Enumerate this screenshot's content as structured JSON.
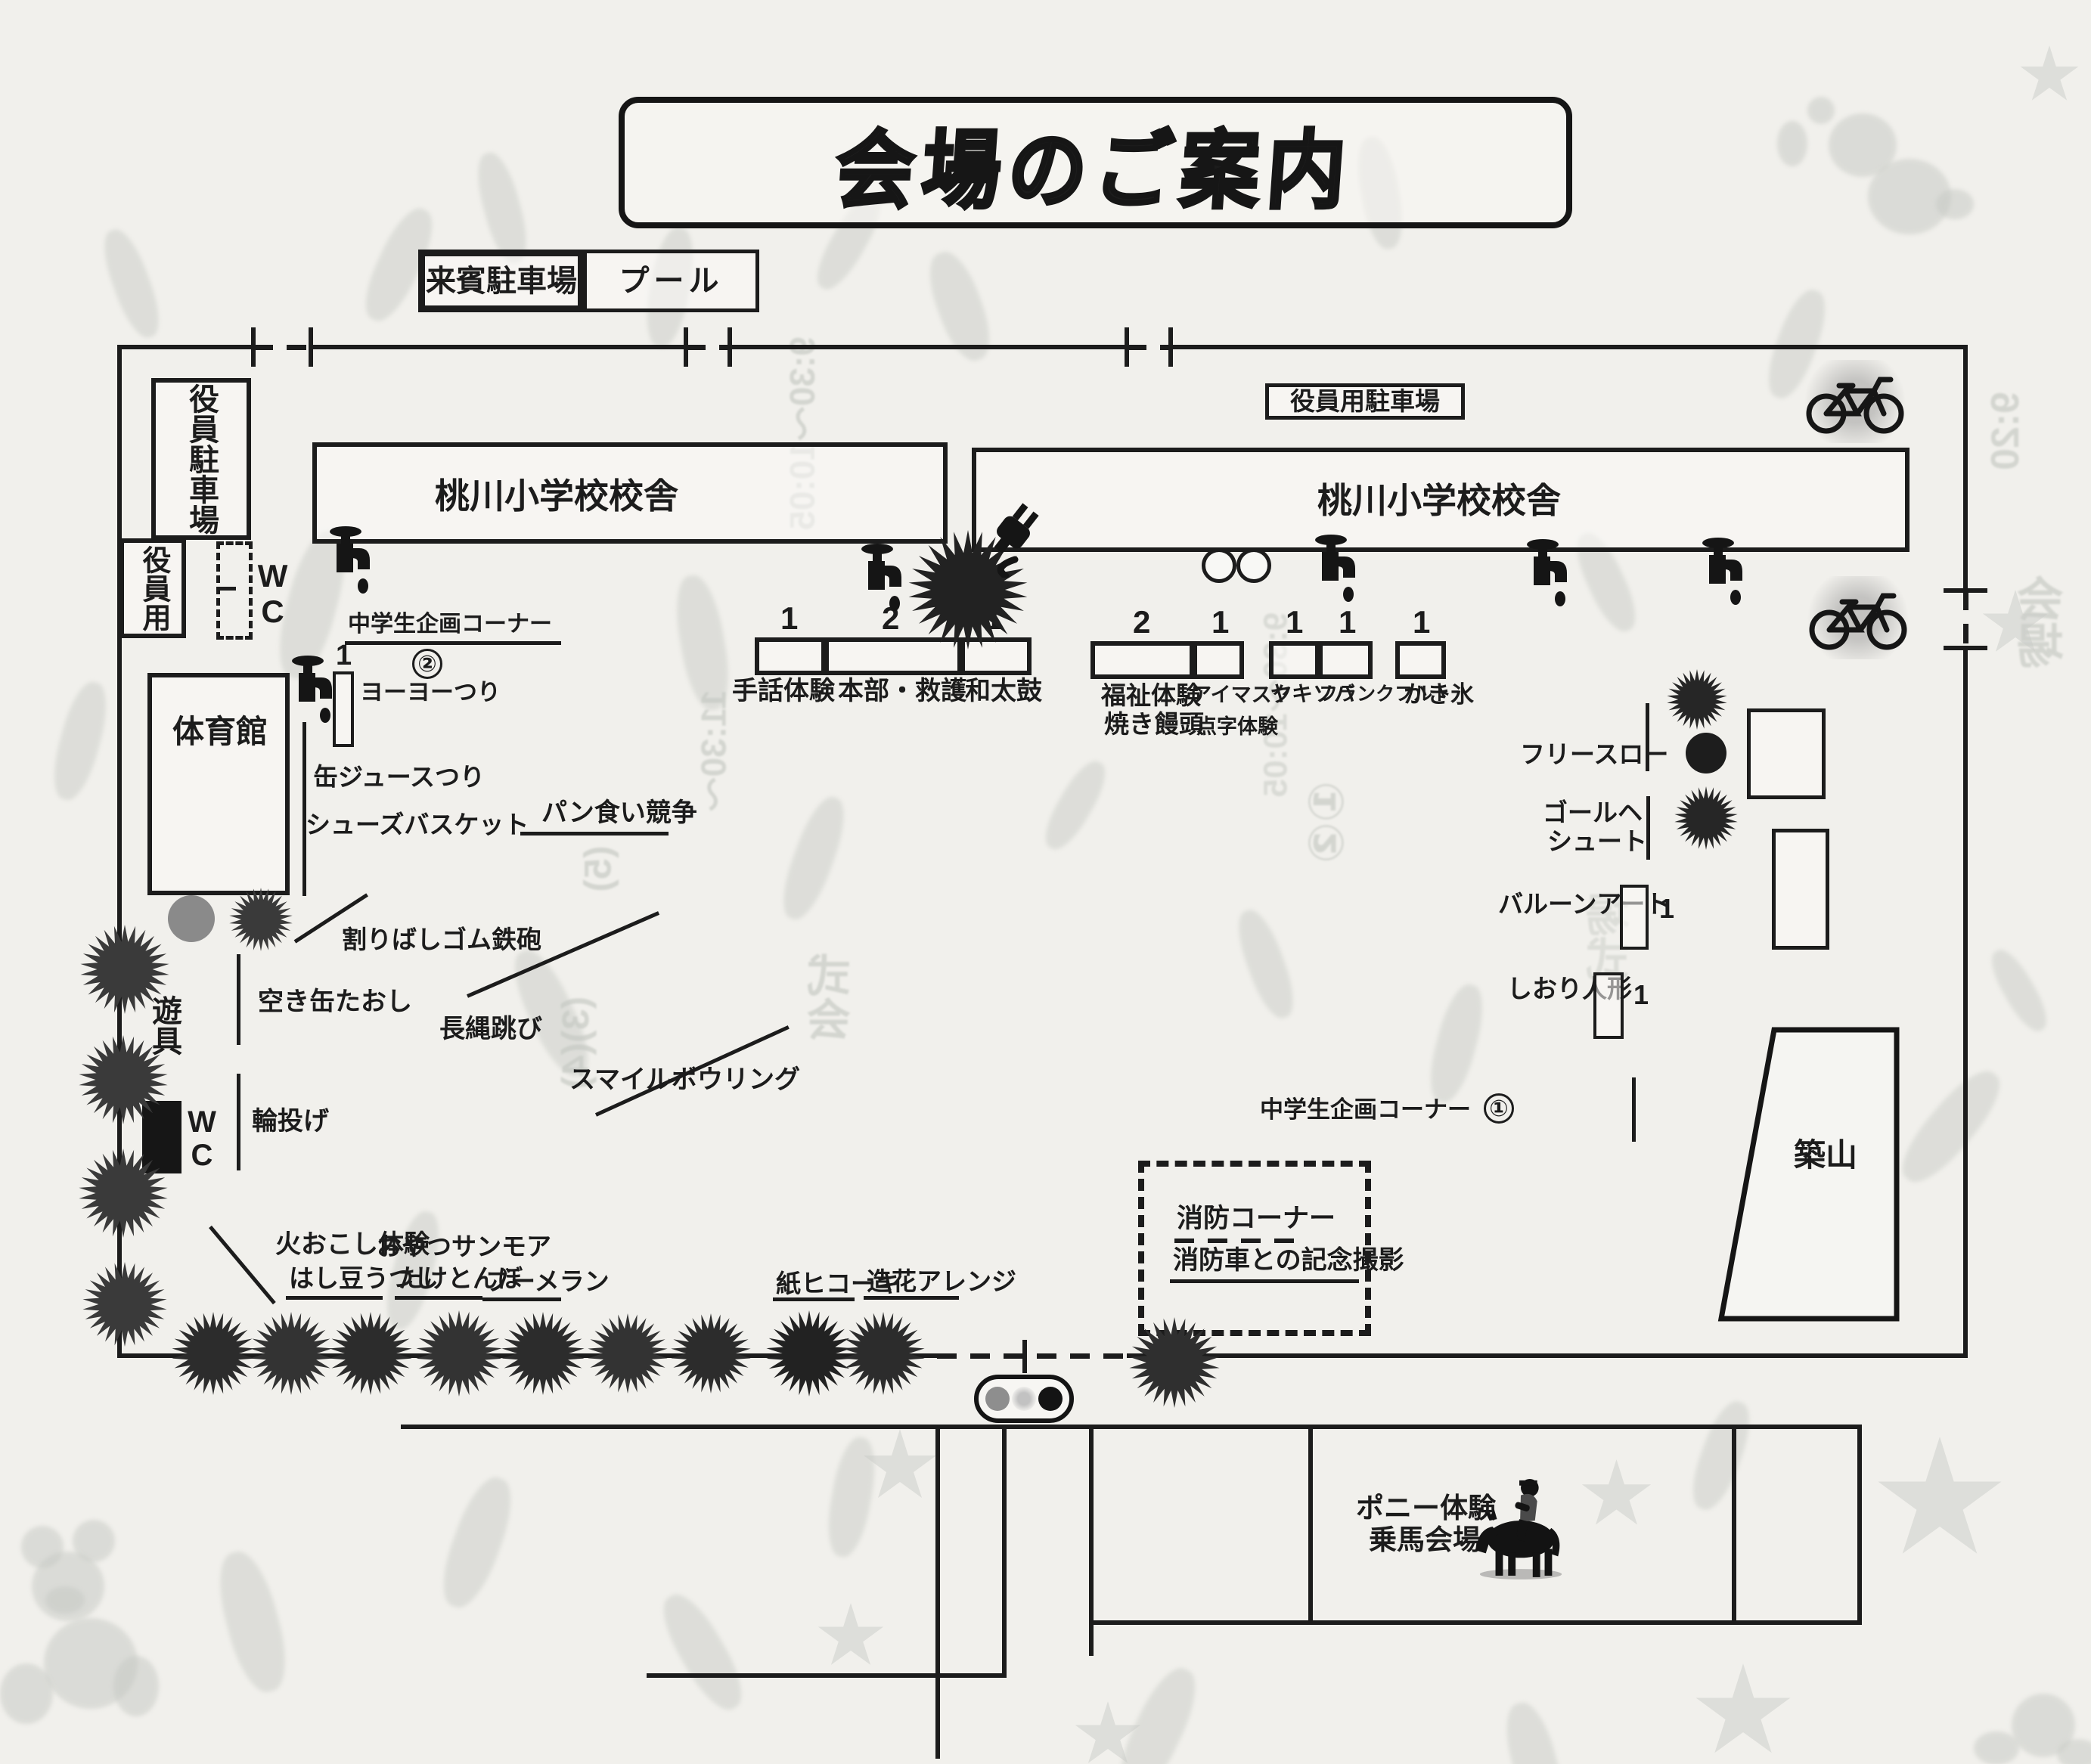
{
  "title": "会場のご案内",
  "parking": {
    "guest": "来賓駐車場",
    "pool": "プール",
    "staff_vertical": "役員駐車場",
    "staff_use": "役員用",
    "staff_lot": "役員用駐車場"
  },
  "wc": {
    "top": "WC",
    "bottom": "WC"
  },
  "buildings": {
    "school1": "桃川小学校校舎",
    "school2": "桃川小学校校舎",
    "gym": "体育館",
    "hill": "築山",
    "playground": "遊具"
  },
  "stations_row1": [
    {
      "name": "手話体験",
      "count": "1"
    },
    {
      "name": "本部・救護",
      "count": "2"
    },
    {
      "name": "和太鼓",
      "count": "1"
    }
  ],
  "stations_row2": [
    {
      "name": "福祉体験",
      "name2": "焼き饅頭",
      "count": "2"
    },
    {
      "name": "アイマスク",
      "name2": "点字体験",
      "count": "1"
    },
    {
      "name": "ヤキソバ",
      "count": "1"
    },
    {
      "name": "フランクフルト",
      "count": "1"
    },
    {
      "name": "かき氷",
      "count": "1"
    }
  ],
  "yoyo": {
    "label": "ヨーヨーつり",
    "count": "1"
  },
  "junior_corner2": {
    "label": "中学生企画コーナー",
    "badge": "②"
  },
  "junior_corner1": {
    "label": "中学生企画コーナー",
    "badge": "①"
  },
  "activities": {
    "pan": "パン食い競争",
    "kanjuice": "缶ジュースつり",
    "shoes": "シューズバスケット",
    "waribashi": "割りばしゴム鉄砲",
    "akikan": "空き缶たおし",
    "naganawa": "長縄跳び",
    "smile": "スマイルボウリング",
    "wanage": "輪投げ",
    "hiokoshi": "火おこし体験",
    "hashimame": "はし豆うつし",
    "oyatsu": "おやつサンモア",
    "taketonbo": "たけとんぼ",
    "boomerang": "ブーメラン",
    "kamihikoki": "紙ヒコーキ",
    "zouka": "造花アレンジ",
    "freethrow": "フリースロー",
    "goal_line1": "ゴールヘ",
    "goal_line2": "シュート",
    "balloon": {
      "label": "バルーンアート",
      "count": "1"
    },
    "shiori": {
      "label": "しおり人形",
      "count": "1"
    }
  },
  "fire_corner": {
    "line1": "消防コーナー",
    "line2": "消防車との記念撮影"
  },
  "pony": {
    "line1": "ポニー体験",
    "line2": "乗馬会場"
  },
  "icons": {
    "faucet": "water-faucet",
    "bicycle": "bicycle",
    "plug": "power-plug",
    "tree": "tree-starburst",
    "pony_rider": "pony-rider",
    "tables": "round-tables",
    "legend": "three-dot-legend"
  },
  "colors": {
    "paper": "#f1f0ec",
    "ink": "#1c1c1c",
    "ghost": "#c3c7c2",
    "gray_fill": "#8a8a8a"
  },
  "ghost_fragments": [
    "9:30〜10:05",
    "11:30〜",
    "9:20",
    "(3)",
    "(4)",
    "(5)",
    "①②",
    "会",
    "場",
    "式"
  ]
}
